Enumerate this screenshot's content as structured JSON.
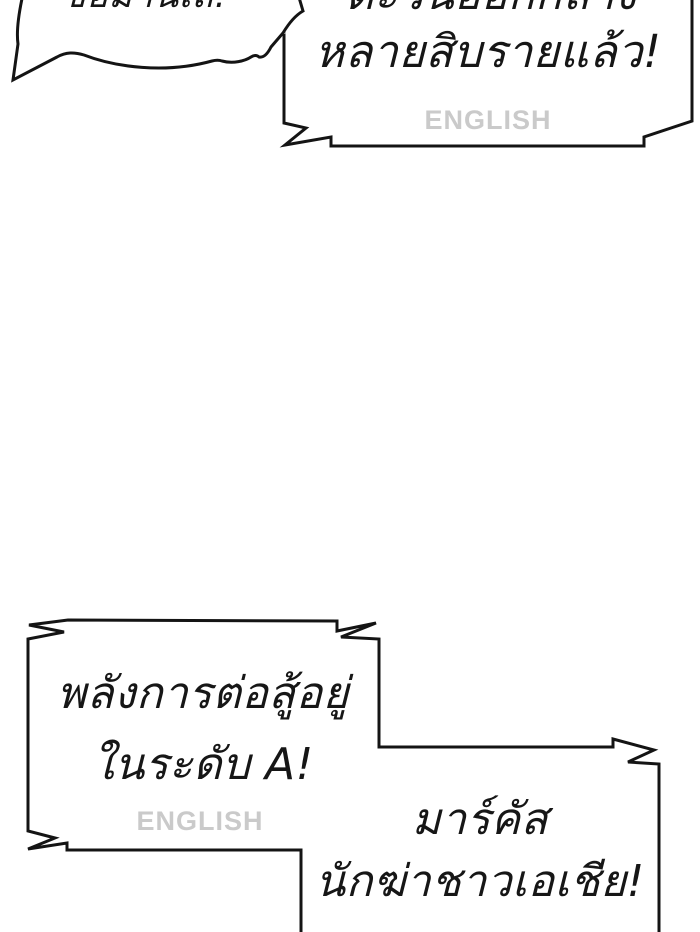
{
  "canvas": {
    "width": 700,
    "height": 932
  },
  "colors": {
    "background": "#ffffff",
    "bubble_outline": "#141414",
    "bubble_fill": "#ffffff",
    "text": "#161616",
    "watermark": "#cacaca",
    "faded_divider": "#c6c6c6"
  },
  "bubbles": {
    "top_left_cloud": {
      "clipped_line": "ขอมานเถ!"
    },
    "top_right": {
      "clipped_line": "ตะวันออกกลาง",
      "line": "หลายสิบรายแล้ว!",
      "watermark": "ENGLISH"
    },
    "bottom_left": {
      "line1": "พลังการต่อสู้อยู่",
      "line2": "ในระดับ A!",
      "watermark": "ENGLISH"
    },
    "bottom_right": {
      "line1": "มาร์คัส",
      "line2": "นักฆ่าชาวเอเชีย!"
    }
  }
}
